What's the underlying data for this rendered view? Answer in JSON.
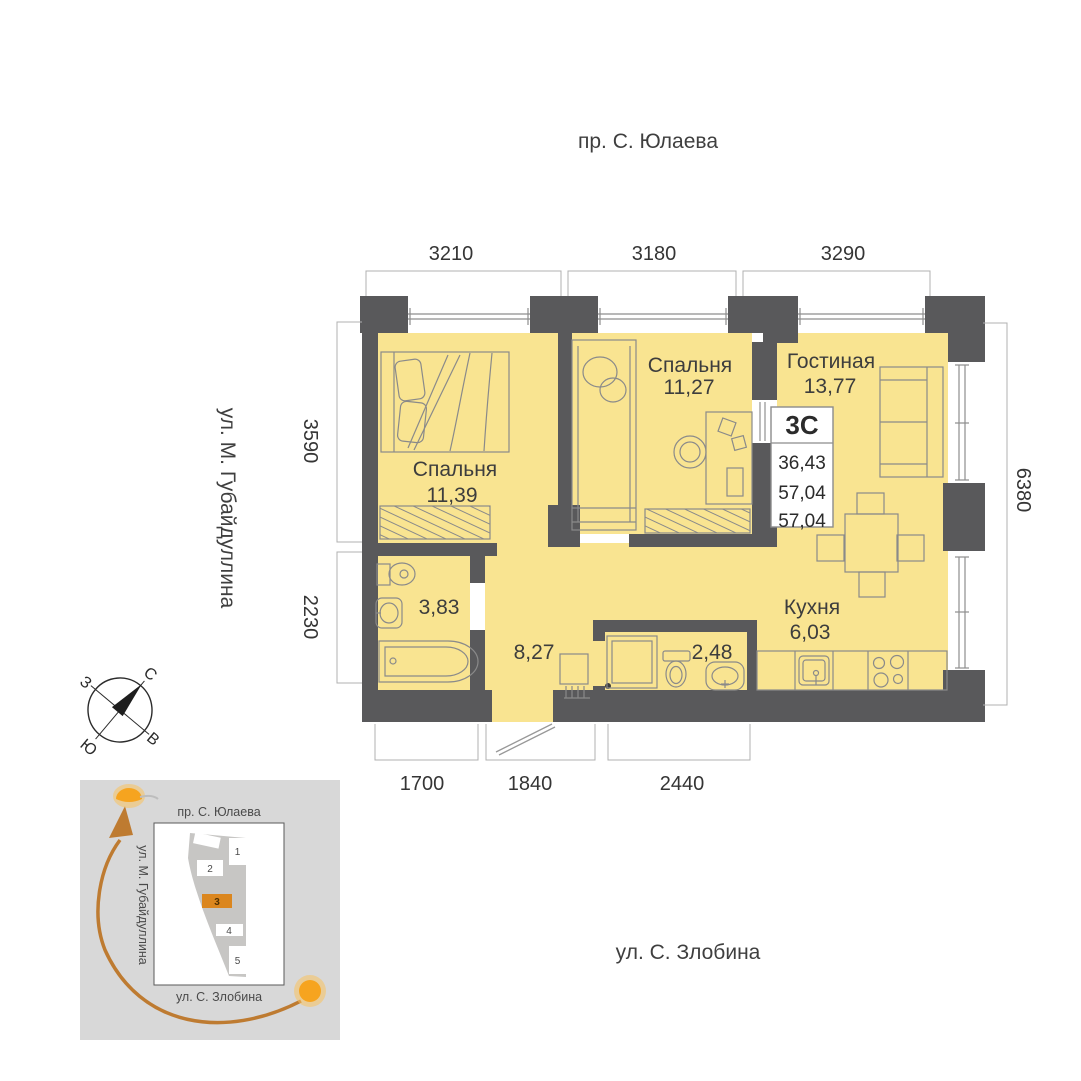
{
  "streets": {
    "top": "пр. С. Юлаева",
    "left": "ул. М. Губайдуллина",
    "bottom": "ул. С. Злобина"
  },
  "dimensions_mm": {
    "top": [
      "3210",
      "3180",
      "3290"
    ],
    "left": [
      "3590",
      "2230"
    ],
    "right": [
      "6380"
    ],
    "bottom": [
      "1700",
      "1840",
      "2440"
    ]
  },
  "rooms": {
    "bedroom1": {
      "label": "Спальня",
      "area": "11,39"
    },
    "bedroom2": {
      "label": "Спальня",
      "area": "11,27"
    },
    "living": {
      "label": "Гостиная",
      "area": "13,77"
    },
    "kitchen": {
      "label": "Кухня",
      "area": "6,03"
    },
    "bathroom": {
      "area": "3,83"
    },
    "hallway": {
      "area": "8,27"
    },
    "wc": {
      "area": "2,48"
    }
  },
  "apartment_card": {
    "type_label": "3С",
    "values": [
      "36,43",
      "57,04",
      "57,04"
    ]
  },
  "compass": {
    "north": "С",
    "east": "В",
    "south": "Ю",
    "west": "З"
  },
  "minimap": {
    "street_top": "пр. С. Юлаева",
    "street_left": "ул. М. Губайдуллина",
    "street_bottom": "ул. С. Злобина",
    "building_numbers": [
      "1",
      "2",
      "3",
      "4",
      "5"
    ],
    "highlighted_building": "3"
  },
  "colors": {
    "room_fill": "#F9E491",
    "wall": "#59595B",
    "furniture_line": "#8a8a8a",
    "highlight_orange": "#DB861E",
    "sun": "#F6A41F",
    "sun_glow": "#F9C35E",
    "sun_arc": "#BE7B31",
    "minimap_bg": "#D8D8D8",
    "site_polygon": "#C7C6C4"
  }
}
